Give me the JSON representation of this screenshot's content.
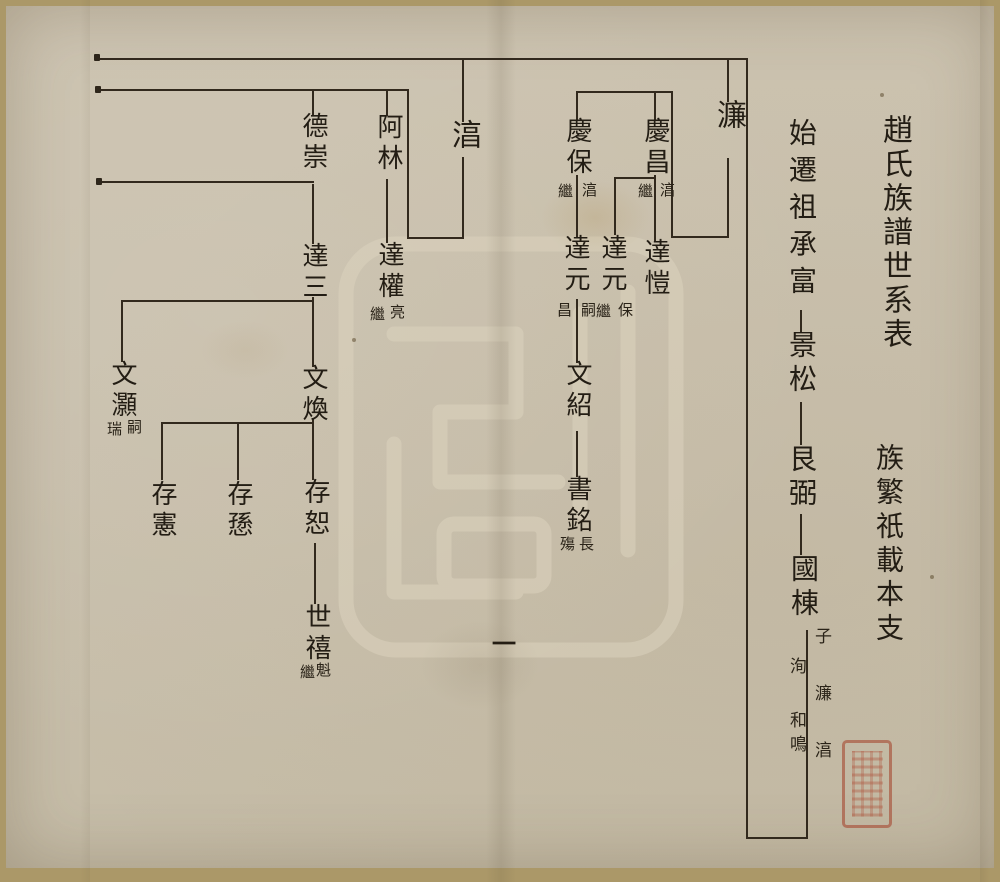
{
  "document": {
    "title": "趙氏族譜世系表",
    "motto": "族繁祇載本支",
    "page_number": "一",
    "ancestor_column": {
      "start": "始遷祖承富",
      "gen2": "景松",
      "gen3": "艮弼",
      "gen4": "國棟",
      "sons_right": "子濂湻",
      "sons_left_a": "洵",
      "sons_left_b": "和鳴",
      "reading": "子：濂、湻、洵、和鳴"
    },
    "seal": {
      "color": "#a5402b",
      "description": "red collector seal, seal-script characters (illegible)"
    }
  },
  "persons": {
    "lian": {
      "name": "濂"
    },
    "chun": {
      "name": "湻"
    },
    "qingchang": {
      "name": "慶昌",
      "note_right": "湻",
      "note_left": "繼"
    },
    "qingbao": {
      "name": "慶保",
      "note_right": "湻",
      "note_left": "繼"
    },
    "dakai": {
      "name": "達愷"
    },
    "dayuan_chang": {
      "name": "達元",
      "note_right": "保",
      "note_left": "繼"
    },
    "dayuan_bao": {
      "name": "達元",
      "note_right": "嗣",
      "note_left": "昌"
    },
    "wenshao": {
      "name": "文紹"
    },
    "shuming": {
      "name": "書銘",
      "note_right": "長",
      "note_left": "殤"
    },
    "alin": {
      "name": "阿林"
    },
    "daquan": {
      "name": "達權",
      "note_right": "亮",
      "note_left": "繼"
    },
    "dechong": {
      "name": "德崇"
    },
    "dasan": {
      "name": "達三"
    },
    "wenhao": {
      "name": "文灝",
      "note_right": "嗣",
      "note_left": "瑞"
    },
    "wenhuan": {
      "name": "文煥"
    },
    "cunxian": {
      "name": "存憲"
    },
    "cunxun": {
      "name": "存愻"
    },
    "cunshu": {
      "name": "存恕"
    },
    "shixi": {
      "name": "世禧",
      "note_right": "魁",
      "note_left": "繼"
    }
  },
  "tree": {
    "root_line": [
      "始遷祖承富",
      "景松",
      "艮弼",
      "國棟"
    ],
    "guodong_sons": [
      "濂",
      "湻",
      "洵",
      "和鳴"
    ],
    "branches": [
      {
        "parent": "濂",
        "children": [
          "慶昌(湻繼)",
          "慶保(湻繼)"
        ]
      },
      {
        "parent": "慶昌",
        "children": [
          "達愷",
          "達元(保繼)"
        ]
      },
      {
        "parent": "慶保",
        "children": [
          "達元(嗣昌)"
        ]
      },
      {
        "parent": "達元",
        "children": [
          "文紹"
        ]
      },
      {
        "parent": "文紹",
        "children": [
          "書銘(長殤)"
        ]
      },
      {
        "parent": "湻",
        "children": [
          "阿林",
          "德崇"
        ]
      },
      {
        "parent": "阿林",
        "children": [
          "達權(亮繼)"
        ]
      },
      {
        "parent": "德崇",
        "children": [
          "達三"
        ]
      },
      {
        "parent": "達三",
        "children": [
          "文灝(嗣瑞)",
          "文煥"
        ]
      },
      {
        "parent": "文煥",
        "children": [
          "存憲",
          "存愻",
          "存恕"
        ]
      },
      {
        "parent": "存恕",
        "children": [
          "世禧(魁繼)"
        ]
      }
    ]
  }
}
